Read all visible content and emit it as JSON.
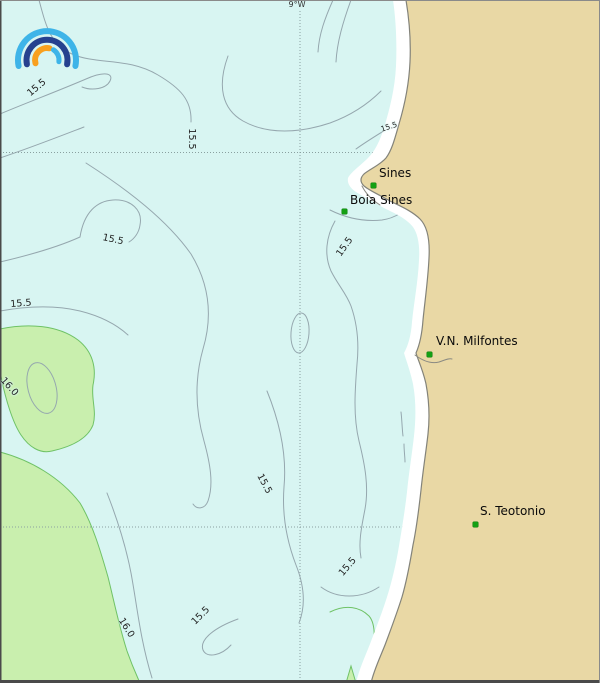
{
  "map": {
    "grid": {
      "meridian_label": "9°W"
    },
    "logo": {
      "icon": "ipma-rainbow-arcs-logo"
    },
    "places": [
      {
        "name": "Sines",
        "label_x": 379,
        "label_y": 167,
        "dot_x": 373,
        "dot_y": 185
      },
      {
        "name": "Boia Sines",
        "label_x": 350,
        "label_y": 194,
        "dot_x": 344,
        "dot_y": 211
      },
      {
        "name": "V.N. Milfontes",
        "label_x": 436,
        "label_y": 335,
        "dot_x": 429,
        "dot_y": 354
      },
      {
        "name": "S. Teotonio",
        "label_x": 480,
        "label_y": 505,
        "dot_x": 475,
        "dot_y": 524
      }
    ],
    "contour_labels": [
      {
        "text": "15.5",
        "x": 37,
        "y": 88,
        "rot": -40
      },
      {
        "text": "15.5",
        "x": 191,
        "y": 139,
        "rot": 90
      },
      {
        "text": "15.5",
        "x": 389,
        "y": 127,
        "rot": -18,
        "small": true
      },
      {
        "text": "15.5",
        "x": 113,
        "y": 240,
        "rot": 12
      },
      {
        "text": "15.5",
        "x": 21,
        "y": 304,
        "rot": -5
      },
      {
        "text": "15.5",
        "x": 345,
        "y": 247,
        "rot": -55
      },
      {
        "text": "16.0",
        "x": 9,
        "y": 387,
        "rot": 48
      },
      {
        "text": "15.5",
        "x": 264,
        "y": 484,
        "rot": 62
      },
      {
        "text": "15.5",
        "x": 348,
        "y": 567,
        "rot": -50
      },
      {
        "text": "15.5",
        "x": 201,
        "y": 616,
        "rot": -45
      },
      {
        "text": "16.0",
        "x": 126,
        "y": 628,
        "rot": 58
      }
    ],
    "colors": {
      "ocean": "#d8f5f2",
      "land": "#e9d8a5",
      "coast_band": "#ffffff",
      "warm_patch": "#c9efae",
      "contour_line": "#95a7ae",
      "warm_contour_line": "#6fc266",
      "station_dot": "#14a014",
      "grid_line": "#8aa0a0",
      "coastline": "#83837a",
      "logo_light_blue": "#3eb4e8",
      "logo_dark_blue": "#26418f",
      "logo_orange": "#f8a01e"
    }
  }
}
